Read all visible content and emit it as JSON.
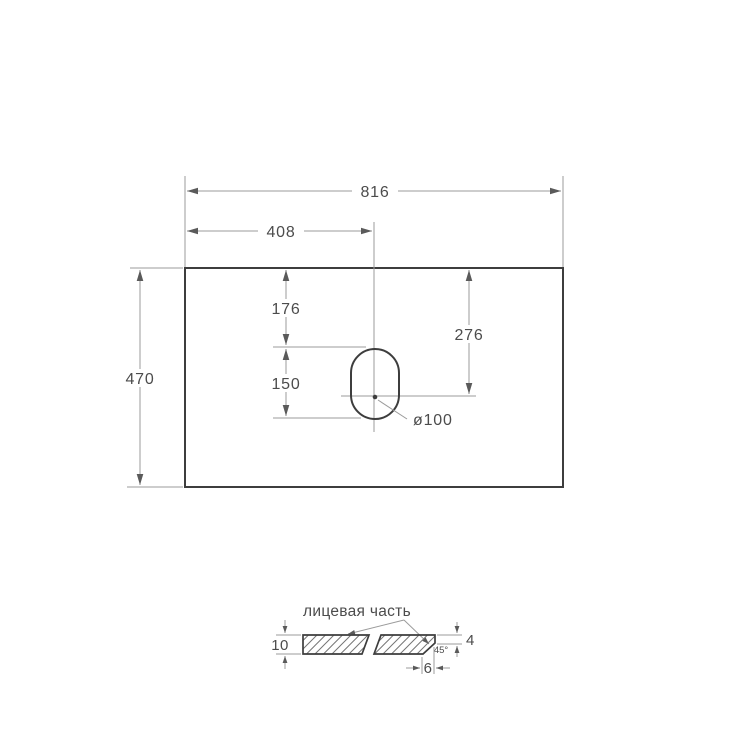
{
  "top_view": {
    "width": "816",
    "hole_center_from_left": "408",
    "depth": "470",
    "hole_top_offset": "176",
    "hole_length": "150",
    "hole_center_offset": "276",
    "hole_diameter": "ø100"
  },
  "section_view": {
    "face_label": "лицевая часть",
    "thickness": "10",
    "edge_straight_height": "4",
    "chamfer_angle": "45°",
    "chamfer_width": "6"
  },
  "colors": {
    "outline": "#3d3d3d",
    "dimension_line": "#9b9b9b",
    "text": "#4c4c4c",
    "background": "#ffffff"
  }
}
